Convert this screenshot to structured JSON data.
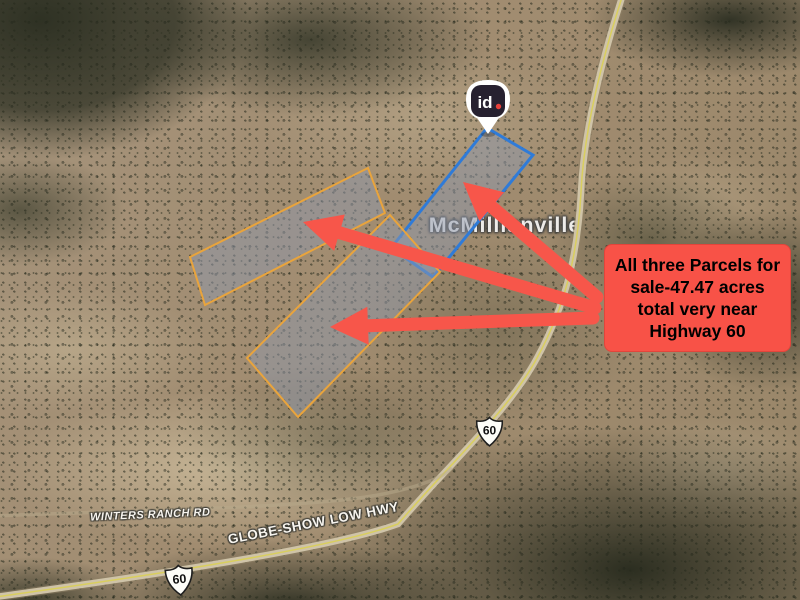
{
  "map": {
    "place_label": "McMillianville",
    "pin": {
      "brand": "id",
      "badge_bg": "#272130",
      "dot_color": "#E8403A"
    },
    "callout": {
      "lines": [
        "All three Parcels for",
        "sale-47.47 acres",
        "total very near",
        "Highway 60"
      ],
      "full_text": "All three Parcels for sale-47.47 acres total very near Highway 60",
      "bg_color": "#F85247",
      "text_color": "#000000"
    },
    "road_labels": [
      {
        "name": "WINTERS RANCH RD"
      },
      {
        "name": "GLOBE-SHOW LOW HWY"
      }
    ],
    "highway_shields": [
      {
        "route": "60"
      },
      {
        "route": "60"
      }
    ],
    "parcels": [
      {
        "outline_color": "#2F7BD8",
        "fill_color": "rgba(142,152,172,0.5)"
      },
      {
        "outline_color": "#E9A43C",
        "fill_color": "rgba(142,152,172,0.5)"
      },
      {
        "outline_color": "#E9A43C",
        "fill_color": "rgba(142,152,172,0.5)"
      }
    ],
    "arrows": {
      "color": "#F7564A",
      "count": 3
    }
  }
}
